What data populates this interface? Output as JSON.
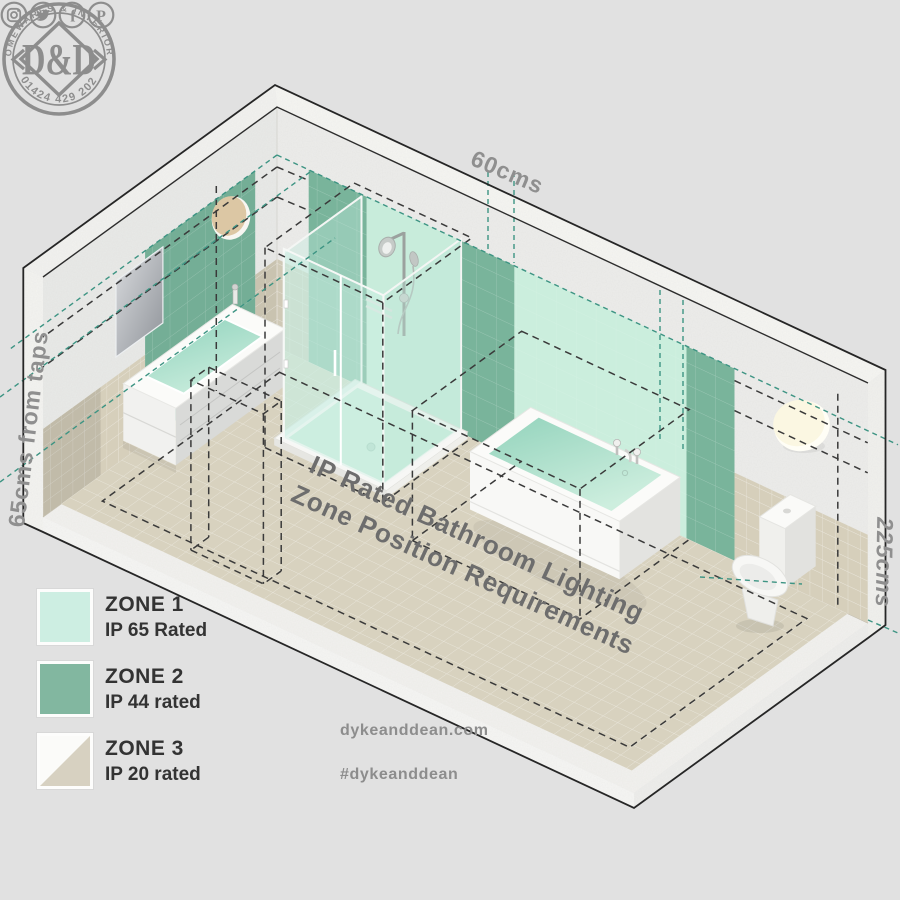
{
  "dimensions": {
    "top": "60cms",
    "left": "65cms from taps",
    "right": "225cms"
  },
  "title": {
    "line1": "IP Rated Bathroom Lighting",
    "line2": "Zone Position Requirements"
  },
  "legend": {
    "items": [
      {
        "zone": "ZONE 1",
        "rating": "IP 65 Rated",
        "color": "#cdeee2"
      },
      {
        "zone": "ZONE 2",
        "rating": "IP 44 rated",
        "color": "#82b7a0"
      },
      {
        "zone": "ZONE 3",
        "rating": "IP 20 rated",
        "color_top": "#fbfbf9",
        "color_bottom": "#d7d1c1"
      }
    ]
  },
  "branding": {
    "stamp_top": "HOMEWARES & INTERIORS",
    "stamp_bottom": "01424 429 202",
    "monogram": "D&D",
    "website": "dykeanddean.com",
    "hashtag": "#dykeanddean",
    "social_icons": [
      "instagram-icon",
      "twitter-icon",
      "facebook-icon",
      "pinterest-icon"
    ]
  },
  "colors": {
    "background": "#e1e1e1",
    "zone1_mint": "#c8ecdb",
    "zone2_green": "#79b49b",
    "zone3_tile": "#d6cfbb",
    "floor": "#d8d2bf",
    "teal_dash": "#3d9483",
    "black_dash": "#3a3a3a",
    "brand_gray": "#8d8d8d"
  }
}
